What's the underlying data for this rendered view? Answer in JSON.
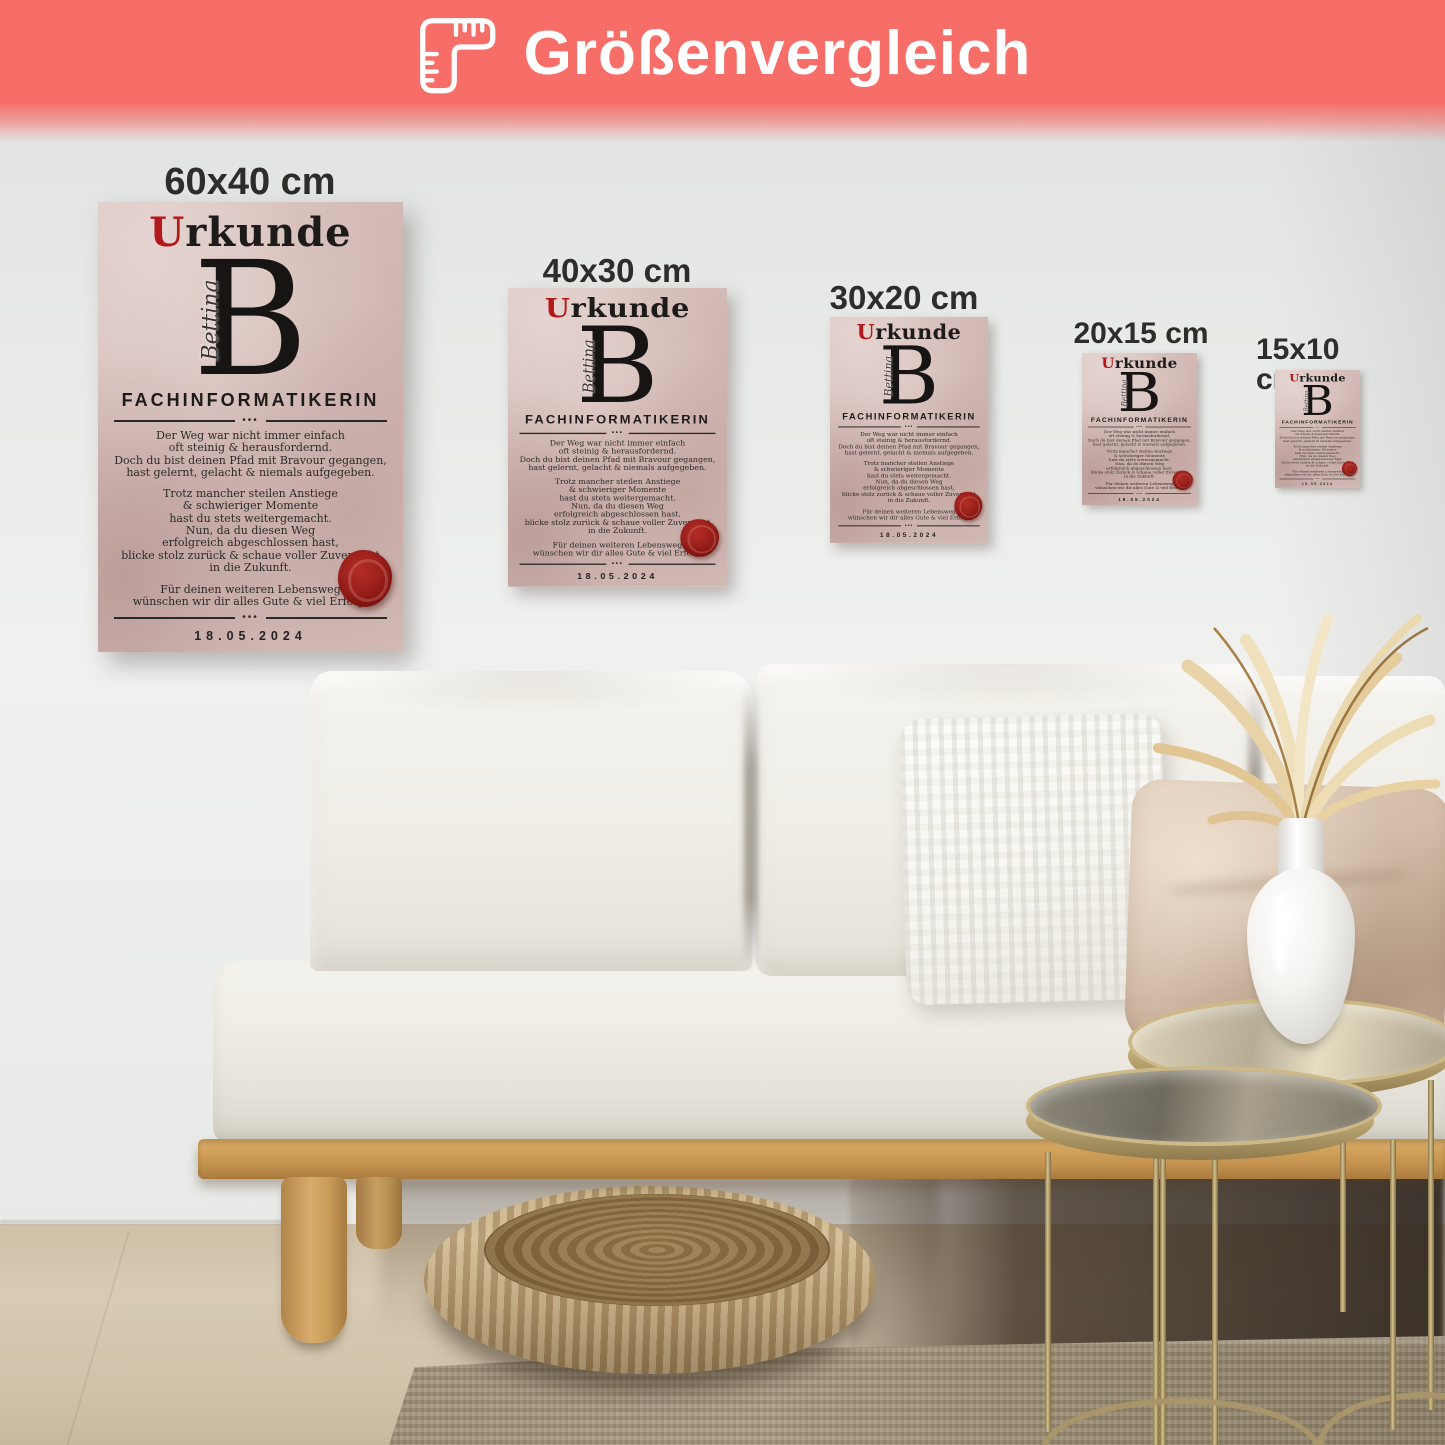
{
  "banner": {
    "title": "Größenvergleich",
    "background_color": "#f76d68",
    "icon": "ruler-icon",
    "text_color": "#ffffff"
  },
  "sizes": [
    {
      "label": "60x40 cm"
    },
    {
      "label": "40x30 cm"
    },
    {
      "label": "30x20 cm"
    },
    {
      "label": "20x15 cm"
    },
    {
      "label": "15x10 cm"
    }
  ],
  "certificate": {
    "title_initial": "U",
    "title_rest": "rkunde",
    "title_accent_color": "#b3181a",
    "monogram": "B",
    "monogram_name": "Bettina",
    "profession": "FACHINFORMATIKERIN",
    "divider_dots": "•••",
    "para1": "Der Weg war nicht immer einfach\noft steinig & herausfordernd.\nDoch du bist deinen Pfad mit Bravour gegangen,\nhast gelernt, gelacht & niemals aufgegeben.",
    "para2": "Trotz mancher steilen Anstiege\n& schwieriger Momente\nhast du stets weitergemacht.\nNun, da du diesen Weg\nerfolgreich abgeschlossen hast,\nblicke stolz zurück & schaue voller Zuversicht\nin die Zukunft.",
    "para3": "Für deinen weiteren Lebensweg\nwünschen wir dir alles Gute & viel Erfolg!",
    "date": "18.05.2024",
    "names": "Anna ♡ James ♡ Lara ♡ Johanna ♡ Kevin",
    "seal_color": "#8e1b17"
  }
}
